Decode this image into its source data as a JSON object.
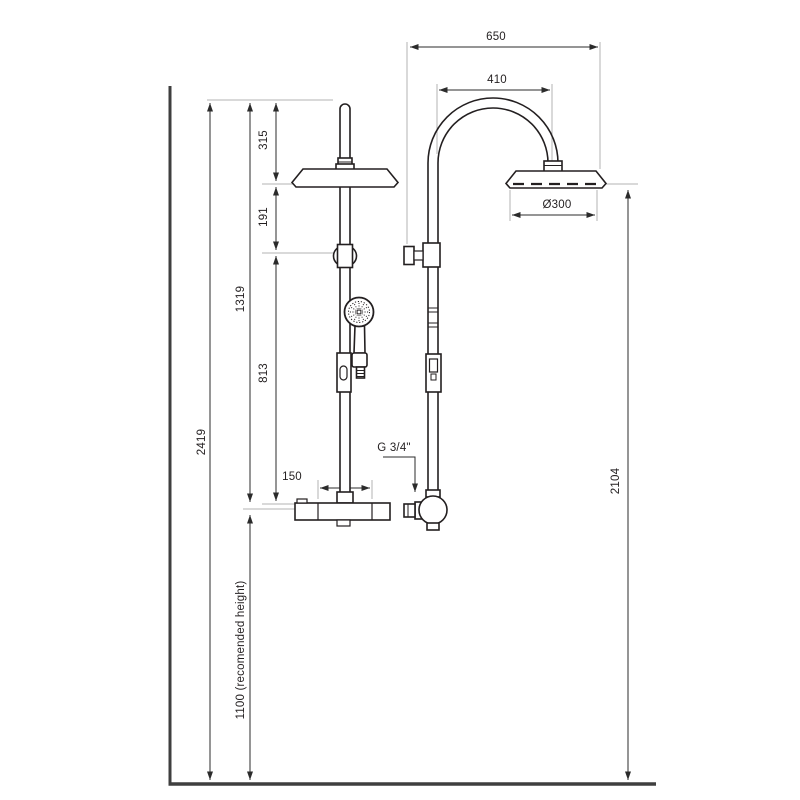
{
  "dimensions": {
    "overall_width": "650",
    "arc_width": "410",
    "head_diameter": "Ø300",
    "pipe_above_head": "315",
    "head_to_diverter": "191",
    "diverter_to_mixer": "813",
    "top_to_mixer": "1319",
    "total_height": "2419",
    "recommended_mixer_height": "1100 (recomended height)",
    "inlet_spacing": "150",
    "connection_thread": "G 3/4\"",
    "side_head_height": "2104"
  },
  "colors": {
    "line": "#231f20",
    "dimension_line": "#2b2b2b",
    "extension_line": "#b3b3b3",
    "heavy_line": "#3f3f3f",
    "background": "#ffffff"
  }
}
